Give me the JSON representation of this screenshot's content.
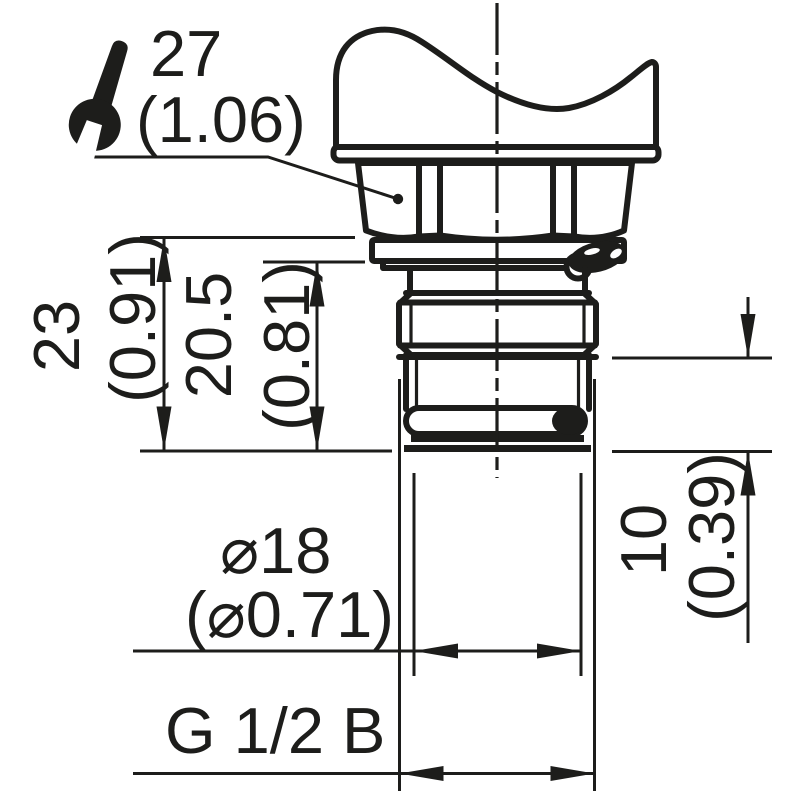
{
  "drawing": {
    "type": "technical-dimension-drawing",
    "part": "threaded process connection with plastic cap, hex nut and o-ring seals",
    "colors": {
      "line": "#1d1d1b",
      "background": "#ffffff"
    },
    "wrench_size": {
      "icon": "wrench-icon",
      "mm": "27",
      "inch": "(1.06)"
    },
    "dimensions": {
      "total_height": {
        "mm": "23",
        "inch": "(0.91)"
      },
      "collar_height": {
        "mm": "20.5",
        "inch": "(0.81)"
      },
      "thread_length": {
        "mm": "10",
        "inch": "(0.39)"
      },
      "diameter": {
        "mm": "⌀18",
        "inch": "(⌀0.71)"
      },
      "thread": {
        "label": "G 1/2 B"
      }
    }
  }
}
